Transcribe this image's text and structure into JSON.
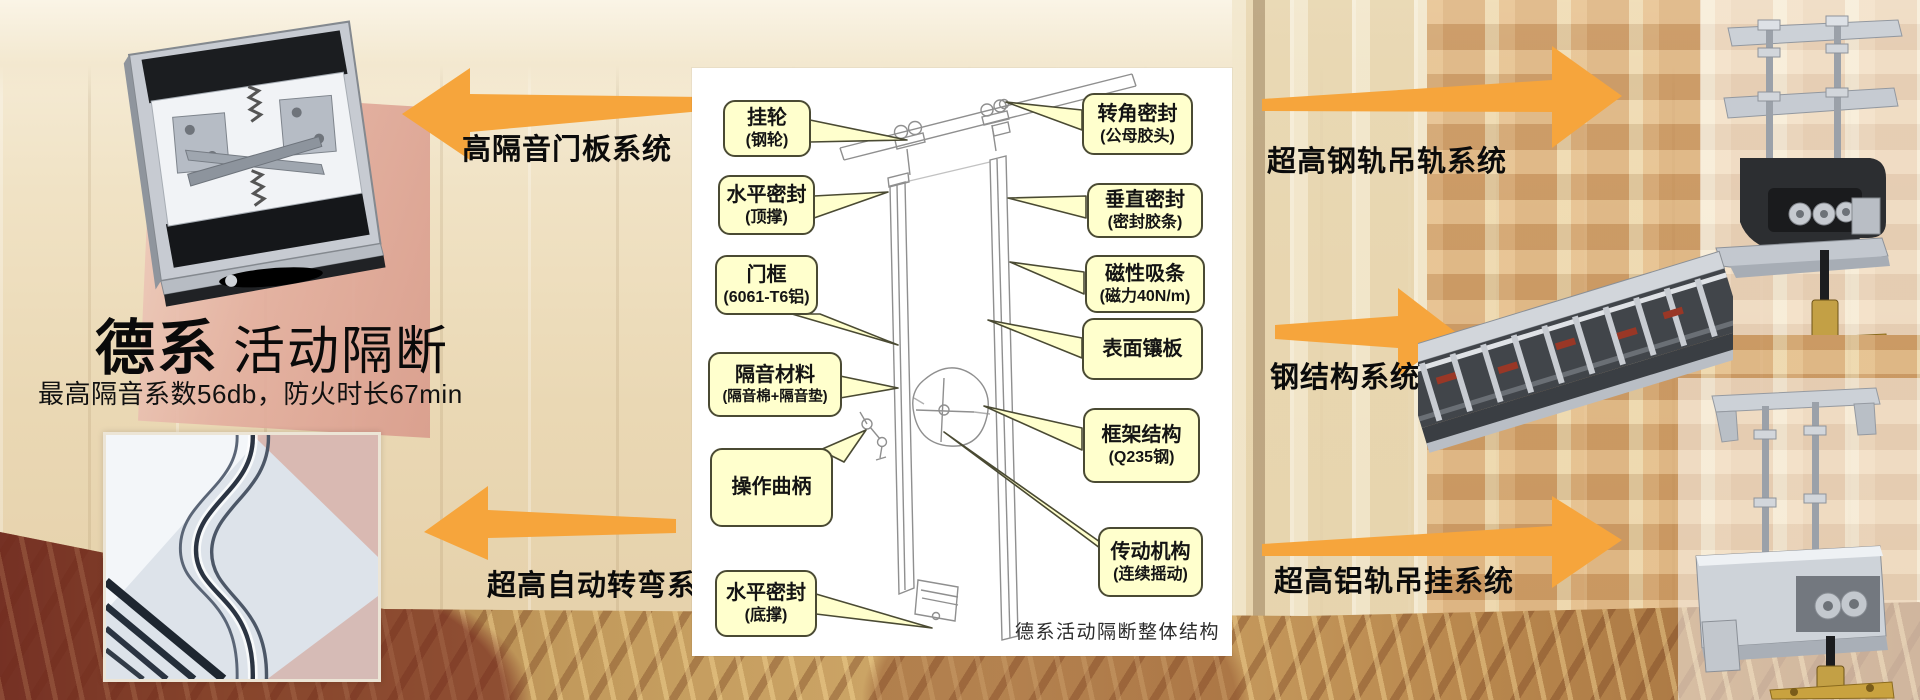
{
  "brand": {
    "title_bold": "德系",
    "title_light": "活动隔断",
    "subtitle": "最高隔音系数56db，防火时长67min"
  },
  "systems": {
    "door_panel": "高隔音门板系统",
    "steel_rail": "超高钢轨吊轨系统",
    "steel_structure": "钢结构系统",
    "auto_turn": "超高自动转弯系统",
    "alu_rail": "超高铝轨吊挂系统"
  },
  "diagram": {
    "caption": "德系活动隔断整体结构",
    "callouts_left": [
      {
        "line1": "挂轮",
        "line2": "(钢轮)"
      },
      {
        "line1": "水平密封",
        "line2": "(顶撑)"
      },
      {
        "line1": "门框",
        "line2": "(6061-T6铝)"
      },
      {
        "line1": "隔音材料",
        "line2": "(隔音棉+隔音垫)"
      },
      {
        "line1": "操作曲柄",
        "line2": ""
      },
      {
        "line1": "水平密封",
        "line2": "(底撑)"
      }
    ],
    "callouts_right": [
      {
        "line1": "转角密封",
        "line2": "(公母胶头)"
      },
      {
        "line1": "垂直密封",
        "line2": "(密封胶条)"
      },
      {
        "line1": "磁性吸条",
        "line2": "(磁力40N/m)"
      },
      {
        "line1": "表面镶板",
        "line2": ""
      },
      {
        "line1": "框架结构",
        "line2": "(Q235钢)"
      },
      {
        "line1": "传动机构",
        "line2": "(连续摇动)"
      }
    ]
  },
  "photos": {
    "top_left": "door-panel-mechanism-photo",
    "bottom_left": "curved-track-photo",
    "top_right": "steel-rail-hanger-photo",
    "middle_right": "steel-frame-structure-photo",
    "bottom_right": "aluminum-rail-hanger-photo"
  },
  "colors": {
    "arrow_orange": "#F6A53C",
    "callout_bg": "#FFFFCD",
    "callout_border": "#4A4A33",
    "panel_bg": "#FFFFFF"
  }
}
